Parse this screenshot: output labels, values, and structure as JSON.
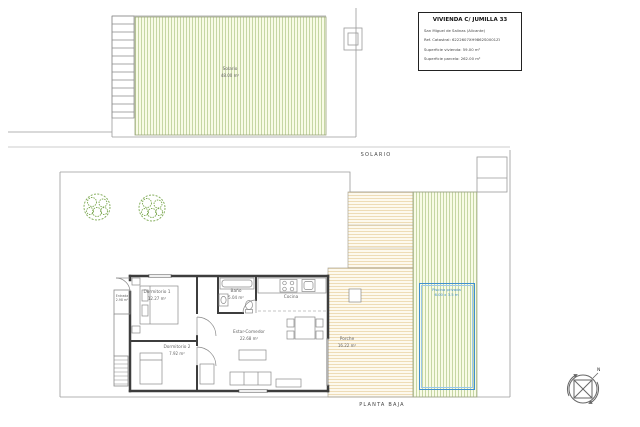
{
  "title_block": {
    "title": "VIVIENDA C/ JUMILLA 33",
    "location": "San Miguel de Salinas (Alicante)",
    "cadastral_ref": "Ref. Catastral: 6222607XH9862S0001ZI",
    "dwelling_area": "Superficie vivienda: 59.00 m²",
    "plot_area": "Superficie parcela: 262.00 m²"
  },
  "plan_labels": {
    "upper": "SOLARIO",
    "lower": "PLANTA BAJA"
  },
  "rooms": {
    "solario": {
      "name": "Solario",
      "area": "48.00 m²"
    },
    "dormitorio_1": {
      "name": "Dormitorio 1",
      "area": "12.27 m²"
    },
    "dormitorio_2": {
      "name": "Dormitorio 2",
      "area": "7.92 m²"
    },
    "bano": {
      "name": "Baño",
      "area": "5.04 m²"
    },
    "cocina": {
      "name": "Cocina"
    },
    "estar_comedor": {
      "name": "Estar-Comedor",
      "area": "22.68 m²"
    },
    "porche": {
      "name": "Porche",
      "area": "16.22 m²"
    },
    "entrada": {
      "name": "Entrada",
      "area": "2.98 m²"
    },
    "piscina": {
      "name": "Piscina privada",
      "dimensions": "6.00 x 3.5 m"
    }
  },
  "compass": {
    "north": "N"
  },
  "colors": {
    "hatch_green_line": "#b7cd8a",
    "hatch_green_bg": "#f8fbe6",
    "hatch_yellow_line": "#e9cf96",
    "hatch_yellow_bg": "#fdf9ee",
    "pool_blue": "#3f8fd0",
    "wall": "#3d3d3d",
    "tree_green": "#7aa74e",
    "line_gray": "#9a9a9a"
  }
}
